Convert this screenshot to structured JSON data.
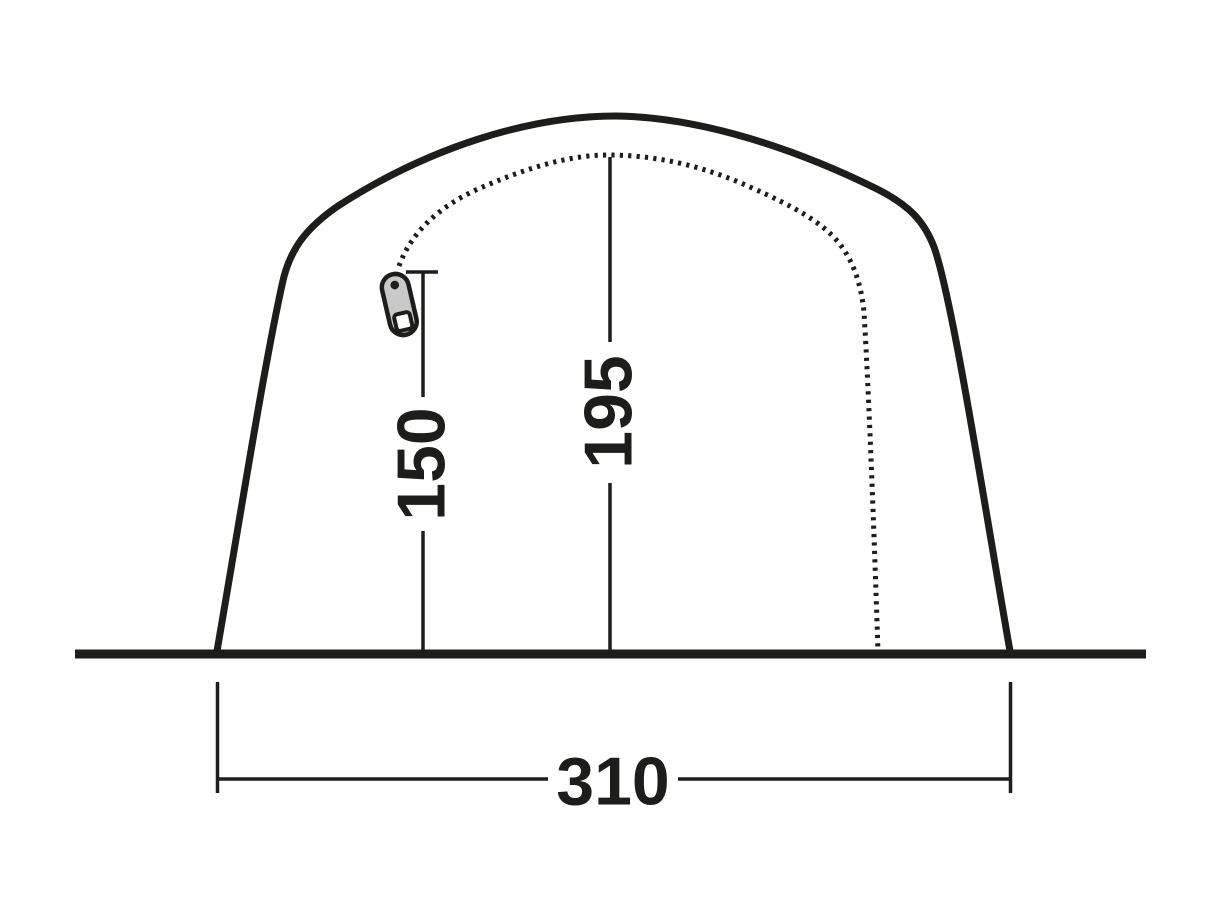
{
  "diagram": {
    "type": "tent-front-elevation-dimension-diagram",
    "colors": {
      "line": "#1d1d1b",
      "background": "#ffffff",
      "zipper_pull_fill": "#c9c9c9",
      "zipper_hole_fill": "#ffffff"
    },
    "dimensions": {
      "door_height": "150",
      "inner_peak_height": "195",
      "base_width": "310"
    },
    "icons": [
      {
        "name": "zipper-pull-icon"
      }
    ]
  }
}
